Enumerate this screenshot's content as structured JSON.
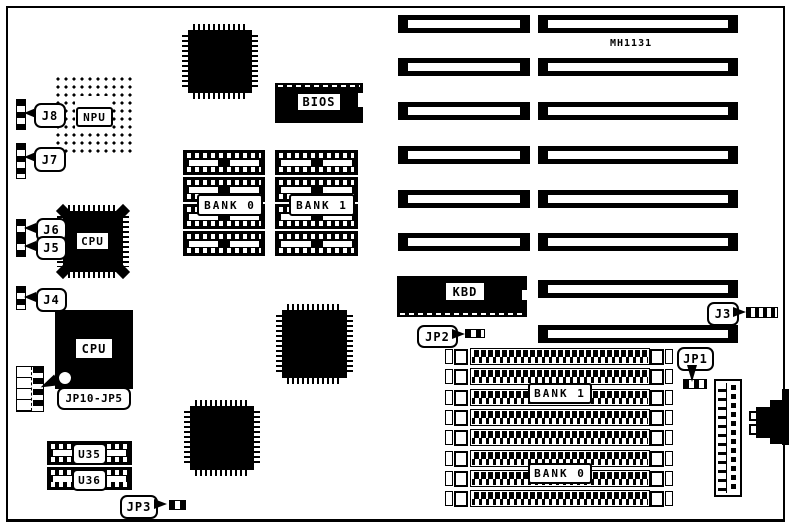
{
  "part_number": "MH1131",
  "chips": {
    "npu": {
      "label": "NPU"
    },
    "cpu_qfp": {
      "label": "CPU"
    },
    "cpu_pga": {
      "label": "CPU"
    },
    "bios": {
      "label": "BIOS"
    },
    "kbd": {
      "label": "KBD"
    },
    "u35": {
      "label": "U35"
    },
    "u36": {
      "label": "U36"
    }
  },
  "connectors": {
    "j8": "J8",
    "j7": "J7",
    "j6": "J6",
    "j5": "J5",
    "j4": "J4",
    "j3": "J3",
    "jp1": "JP1",
    "jp2": "JP2",
    "jp3": "JP3",
    "jp10_jp5": "JP10-JP5"
  },
  "dip_memory": {
    "bank0_label": "BANK 0",
    "bank1_label": "BANK 1",
    "rows_per_bank": 4
  },
  "simm_memory": {
    "bank1_label": "BANK 1",
    "bank0_label": "BANK 0",
    "socket_count": 8
  },
  "expansion_slots": {
    "short_column_count": 6,
    "long_column_count": 8
  }
}
